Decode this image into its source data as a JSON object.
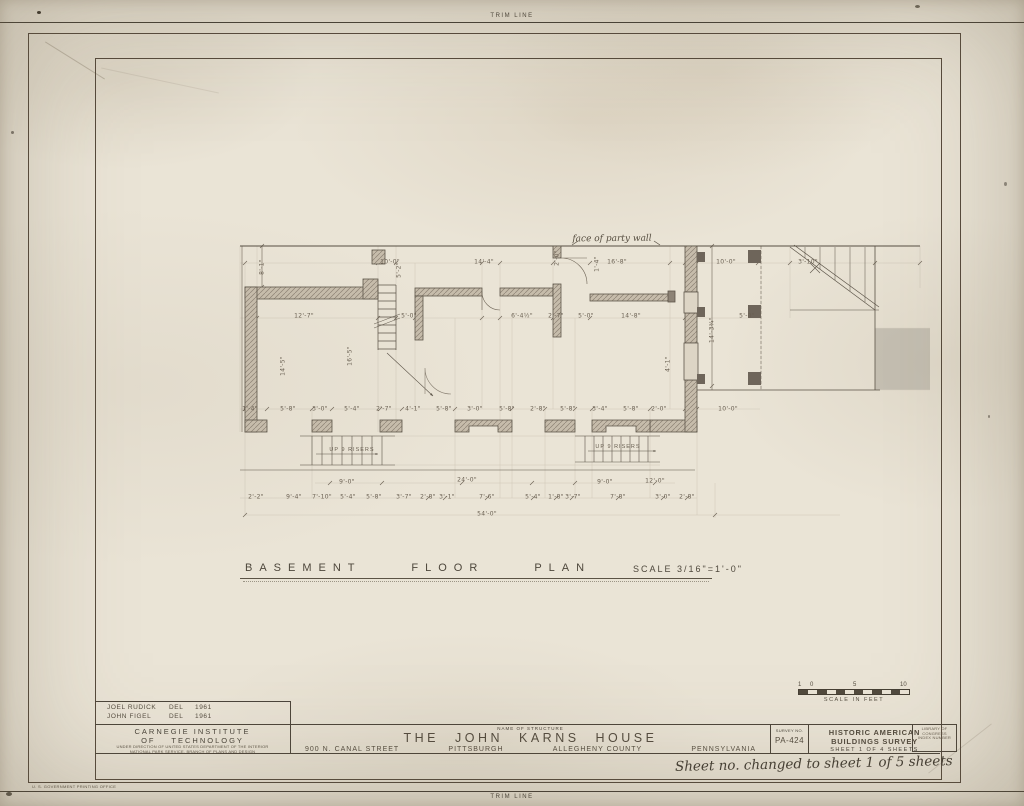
{
  "page": {
    "trim_line_top": "TRIM LINE",
    "trim_line_bottom": "TRIM LINE",
    "printing_note": "U. S. GOVERNMENT PRINTING OFFICE"
  },
  "plan": {
    "title": "BASEMENT FLOOR PLAN",
    "scale_note": "SCALE  3/16\"=1'-0\"",
    "party_wall_note": "face of party wall",
    "stair_note_left": "UP 9 RISERS",
    "stair_note_right": "UP 9 RISERS",
    "dim_labels": [
      {
        "t": "10'-0\"",
        "x": 390,
        "y": 262
      },
      {
        "t": "14'-4\"",
        "x": 484,
        "y": 262
      },
      {
        "t": "16'-8\"",
        "x": 617,
        "y": 262
      },
      {
        "t": "10'-0\"",
        "x": 726,
        "y": 262
      },
      {
        "t": "3'-10\"",
        "x": 808,
        "y": 262
      },
      {
        "t": "8'-1\"",
        "x": 262,
        "y": 267,
        "r": -90
      },
      {
        "t": "5'-2\"",
        "x": 399,
        "y": 270,
        "r": -90
      },
      {
        "t": "2'-0\"",
        "x": 557,
        "y": 258,
        "r": -90
      },
      {
        "t": "1'-4\"",
        "x": 597,
        "y": 264,
        "r": -90
      },
      {
        "t": "12'-7\"",
        "x": 304,
        "y": 316
      },
      {
        "t": "5'-0\"",
        "x": 409,
        "y": 316
      },
      {
        "t": "6'-4½\"",
        "x": 522,
        "y": 316
      },
      {
        "t": "2'-7\"",
        "x": 556,
        "y": 316
      },
      {
        "t": "5'-0\"",
        "x": 586,
        "y": 316
      },
      {
        "t": "14'-8\"",
        "x": 631,
        "y": 316
      },
      {
        "t": "5'-0\"",
        "x": 747,
        "y": 316
      },
      {
        "t": "14'-5\"",
        "x": 283,
        "y": 366,
        "r": -90
      },
      {
        "t": "16'-5\"",
        "x": 350,
        "y": 356,
        "r": -90
      },
      {
        "t": "4'-1\"",
        "x": 668,
        "y": 364,
        "r": -90
      },
      {
        "t": "14'-3¾\"",
        "x": 712,
        "y": 330,
        "r": -90
      },
      {
        "t": "1'-4\"",
        "x": 250,
        "y": 409
      },
      {
        "t": "5'-8\"",
        "x": 288,
        "y": 409
      },
      {
        "t": "3'-0\"",
        "x": 320,
        "y": 409
      },
      {
        "t": "5'-4\"",
        "x": 352,
        "y": 409
      },
      {
        "t": "2'-7\"",
        "x": 384,
        "y": 409
      },
      {
        "t": "4'-1\"",
        "x": 413,
        "y": 409
      },
      {
        "t": "5'-8\"",
        "x": 444,
        "y": 409
      },
      {
        "t": "3'-0\"",
        "x": 475,
        "y": 409
      },
      {
        "t": "5'-8\"",
        "x": 507,
        "y": 409
      },
      {
        "t": "2'-8\"",
        "x": 538,
        "y": 409
      },
      {
        "t": "5'-8\"",
        "x": 568,
        "y": 409
      },
      {
        "t": "3'-4\"",
        "x": 600,
        "y": 409
      },
      {
        "t": "5'-8\"",
        "x": 631,
        "y": 409
      },
      {
        "t": "2'-0\"",
        "x": 659,
        "y": 409
      },
      {
        "t": "10'-0\"",
        "x": 728,
        "y": 409
      },
      {
        "t": "9'-0\"",
        "x": 347,
        "y": 482
      },
      {
        "t": "24'-0\"",
        "x": 467,
        "y": 480
      },
      {
        "t": "9'-0\"",
        "x": 605,
        "y": 482
      },
      {
        "t": "12'-0\"",
        "x": 655,
        "y": 481
      },
      {
        "t": "2'-2\"",
        "x": 256,
        "y": 497
      },
      {
        "t": "9'-4\"",
        "x": 294,
        "y": 497
      },
      {
        "t": "7'-10\"",
        "x": 322,
        "y": 497
      },
      {
        "t": "5'-4\"",
        "x": 348,
        "y": 497
      },
      {
        "t": "5'-8\"",
        "x": 374,
        "y": 497
      },
      {
        "t": "3'-7\"",
        "x": 404,
        "y": 497
      },
      {
        "t": "2'-8\"",
        "x": 428,
        "y": 497
      },
      {
        "t": "3'-1\"",
        "x": 447,
        "y": 497
      },
      {
        "t": "7'-6\"",
        "x": 487,
        "y": 497
      },
      {
        "t": "5'-4\"",
        "x": 533,
        "y": 497
      },
      {
        "t": "1'-8\"",
        "x": 556,
        "y": 497
      },
      {
        "t": "3'-7\"",
        "x": 573,
        "y": 497
      },
      {
        "t": "7'-8\"",
        "x": 618,
        "y": 497
      },
      {
        "t": "3'-0\"",
        "x": 663,
        "y": 497
      },
      {
        "t": "2'-8\"",
        "x": 687,
        "y": 497
      },
      {
        "t": "54'-0\"",
        "x": 487,
        "y": 514
      }
    ]
  },
  "title_block": {
    "credits": [
      {
        "name": "JOEL RUDICK",
        "role": "DEL",
        "year": "1961"
      },
      {
        "name": "JOHN FIGEL",
        "role": "DEL",
        "year": "1961"
      }
    ],
    "institution_line1": "CARNEGIE INSTITUTE",
    "institution_line2": "OF TECHNOLOGY",
    "direction_note_line1": "UNDER DIRECTION OF UNITED STATES DEPARTMENT OF THE INTERIOR",
    "direction_note_line2": "NATIONAL PARK SERVICE, BRANCH OF PLANS AND DESIGN",
    "name_of_structure_label": "NAME OF STRUCTURE",
    "structure_name": "THE JOHN KARNS HOUSE",
    "address": "900 N. CANAL STREET",
    "city": "PITTSBURGH",
    "county": "ALLEGHENY COUNTY",
    "state": "PENNSYLVANIA",
    "survey_no_label": "SURVEY NO.",
    "survey_no": "PA-424",
    "habs_line1": "HISTORIC AMERICAN",
    "habs_line2": "BUILDINGS SURVEY",
    "sheet_line": "SHEET 1 OF 4 SHEETS",
    "loc_box_line1": "LIBRARY OF CONGRESS",
    "loc_box_line2": "INDEX NUMBER",
    "scale_bar": {
      "label": "SCALE IN FEET",
      "ticks": [
        "1",
        "0",
        "5",
        "10"
      ]
    }
  },
  "annotations": {
    "handwritten_note": "Sheet no. changed to sheet 1 of 5 sheets"
  },
  "colors": {
    "paper": "#eae4d6",
    "ink": "#4c453a",
    "dim_ink": "#695f51",
    "wall_fill": "#c6bcab"
  }
}
